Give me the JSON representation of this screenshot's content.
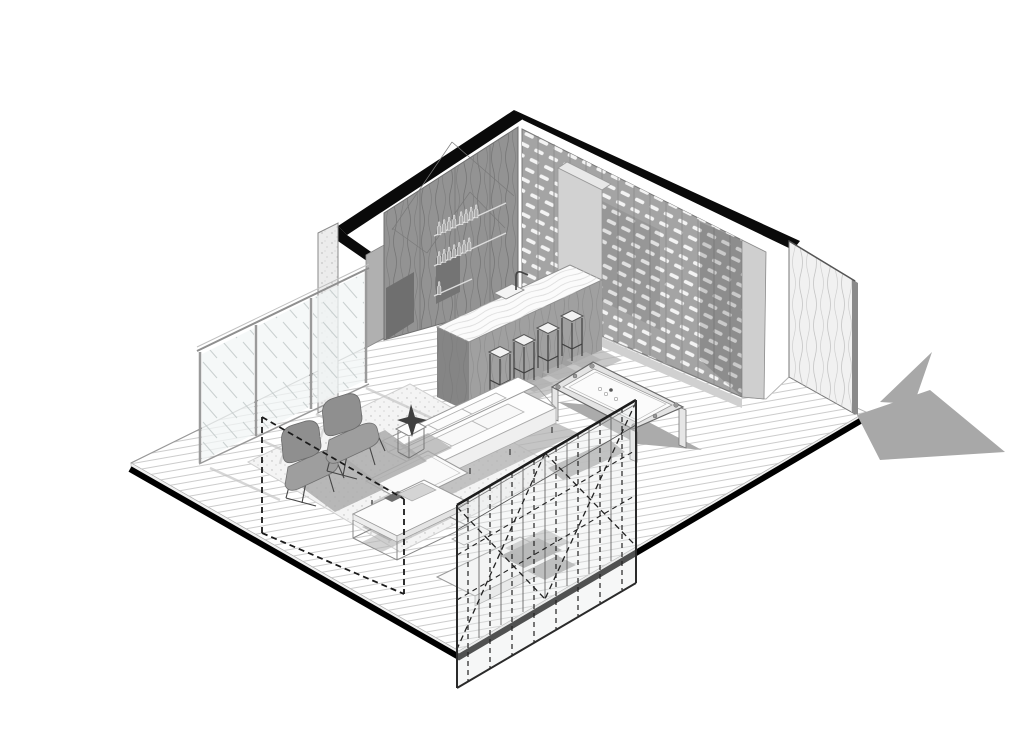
{
  "drawing": {
    "title": "Axonometric cutaway drawing of a lounge bar interior",
    "style": "black and white architectural line drawing",
    "background": "#ffffff"
  },
  "palette": {
    "ink": "#000000",
    "wall_gray": "#939393",
    "rack_gray": "#a4a4a4",
    "light_gray": "#d8d8d8",
    "shadow_gray": "#ababab",
    "floor_line": "#cccccc",
    "white": "#ffffff"
  },
  "labels": {
    "drawing": "Axonometric cutaway of a lounge with bar island, bottle wall, pool table and seating area",
    "cutWalls": "Section-cut walls shown in solid black",
    "floor": "Wood plank floor slab",
    "rug": "Area rug with stipple texture",
    "glassWall": "Left glazed wall with three glass panels",
    "column": "Concrete corner column",
    "barWall": "Dark wood back-bar wall with bottle shelves",
    "bottles": "Bottles on back-bar shelves",
    "wineWall": "Back wall bottle rack grid",
    "fridge": "Tall gray cabinet panel at rack corner",
    "woodPanel": "Freestanding wood-grain end panel",
    "panelShadow": "Shadow cast on the ground by the end panel",
    "barIsland": "Bar island with marble countertop and sink",
    "stools": "Four bar stools",
    "poolTable": "Pool table with pockets and balls",
    "sofa": "White sectional sofa with chaise",
    "armchairs": "Two gray swivel lounge chairs",
    "coffeeTable": "Open-frame coffee table",
    "sideTable": "Side table with dark sculpture",
    "mediaBench": "Low bench and boxes behind the front partition",
    "removedWall": "Dashed outline of removed front-left wall panel",
    "partition": "Transparent front partition with dashed cross bracing"
  },
  "inventory": {
    "cut_walls": 2,
    "glass_wall_panels": 3,
    "wine_rack": {
      "columns": 14,
      "rows": 13
    },
    "bar": {
      "stools": 4,
      "shelf_rows": 3,
      "bottles": {
        "top_shelf": 8,
        "middle_shelf": 7,
        "lower_shelf": 1
      },
      "features": [
        "marble countertop",
        "sink",
        "faucet"
      ]
    },
    "pool_table": {
      "pockets": 6,
      "balls": 4,
      "legs": 4
    },
    "lounge": {
      "armchairs": 2,
      "sofa_cushions": 3,
      "coffee_tables": 1,
      "side_tables": 1,
      "rugs": 1
    },
    "partition": {
      "dashed_vertical_mullions": 8,
      "x_braces": 2,
      "dashed_horizontals": 2
    },
    "freestanding_wood_panels": 1,
    "media_bench_boxes": 2
  }
}
